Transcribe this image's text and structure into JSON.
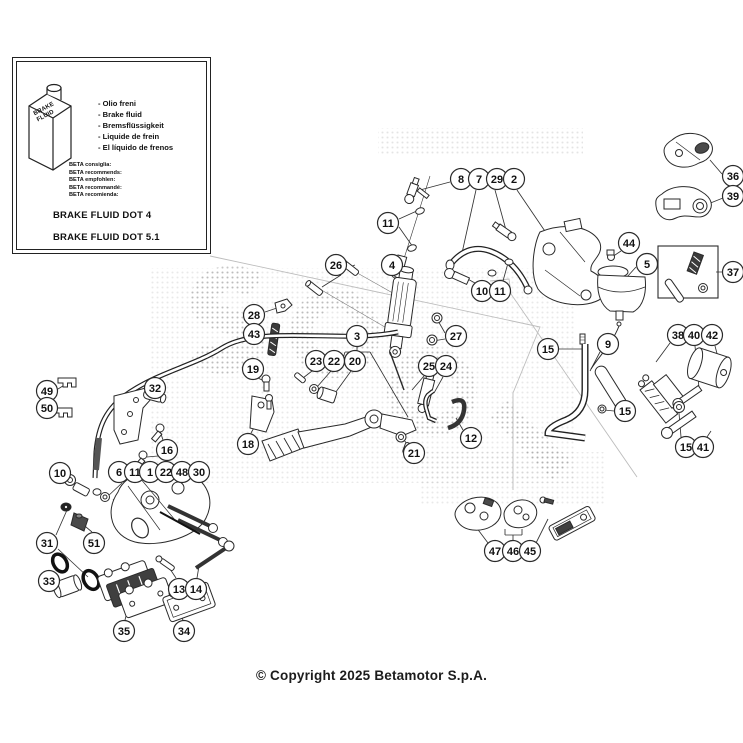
{
  "info_box": {
    "bottle_label": "BRAKE FLUID",
    "fluid_names": [
      "- Olio freni",
      "- Brake fluid",
      "- Bremsflüssigkeit",
      "- Liquide de frein",
      "- El líquido de frenos"
    ],
    "beta_recommends": [
      "BETA consiglia:",
      "BETA recommends:",
      "BETA empfohlen:",
      "BETA recommandé:",
      "BETA recomienda:"
    ],
    "dot4": "BRAKE FLUID DOT 4",
    "dot51": "BRAKE FLUID DOT 5.1"
  },
  "footer": {
    "copyright": "© Copyright 2025 Betamotor S.p.A."
  },
  "colors": {
    "line": "#2a2a2a",
    "faint": "#bdbdbd",
    "dark_fill": "#3f3f3f",
    "halftone": "#8f8f8f"
  },
  "diagram": {
    "callouts": [
      {
        "n": "8",
        "x": 461,
        "y": 179
      },
      {
        "n": "7",
        "x": 479,
        "y": 179
      },
      {
        "n": "29",
        "x": 497,
        "y": 179
      },
      {
        "n": "2",
        "x": 514,
        "y": 179
      },
      {
        "n": "36",
        "x": 733,
        "y": 176
      },
      {
        "n": "39",
        "x": 733,
        "y": 196
      },
      {
        "n": "11",
        "x": 388,
        "y": 223
      },
      {
        "n": "44",
        "x": 629,
        "y": 243
      },
      {
        "n": "26",
        "x": 336,
        "y": 265
      },
      {
        "n": "4",
        "x": 392,
        "y": 265
      },
      {
        "n": "5",
        "x": 647,
        "y": 264
      },
      {
        "n": "37",
        "x": 733,
        "y": 272
      },
      {
        "n": "10",
        "x": 482,
        "y": 291
      },
      {
        "n": "11",
        "x": 500,
        "y": 291
      },
      {
        "n": "28",
        "x": 254,
        "y": 315
      },
      {
        "n": "43",
        "x": 254,
        "y": 334
      },
      {
        "n": "3",
        "x": 357,
        "y": 336
      },
      {
        "n": "27",
        "x": 456,
        "y": 336
      },
      {
        "n": "38",
        "x": 678,
        "y": 335
      },
      {
        "n": "40",
        "x": 694,
        "y": 335
      },
      {
        "n": "42",
        "x": 712,
        "y": 335
      },
      {
        "n": "15",
        "x": 548,
        "y": 349
      },
      {
        "n": "9",
        "x": 608,
        "y": 344
      },
      {
        "n": "23",
        "x": 316,
        "y": 361
      },
      {
        "n": "22",
        "x": 334,
        "y": 361
      },
      {
        "n": "20",
        "x": 355,
        "y": 361
      },
      {
        "n": "25",
        "x": 429,
        "y": 366
      },
      {
        "n": "24",
        "x": 446,
        "y": 366
      },
      {
        "n": "19",
        "x": 253,
        "y": 369
      },
      {
        "n": "49",
        "x": 47,
        "y": 391
      },
      {
        "n": "50",
        "x": 47,
        "y": 408
      },
      {
        "n": "32",
        "x": 155,
        "y": 388
      },
      {
        "n": "15",
        "x": 625,
        "y": 411
      },
      {
        "n": "18",
        "x": 248,
        "y": 444
      },
      {
        "n": "16",
        "x": 167,
        "y": 450
      },
      {
        "n": "12",
        "x": 471,
        "y": 438
      },
      {
        "n": "21",
        "x": 414,
        "y": 453
      },
      {
        "n": "15",
        "x": 686,
        "y": 447
      },
      {
        "n": "41",
        "x": 703,
        "y": 447
      },
      {
        "n": "10",
        "x": 60,
        "y": 473
      },
      {
        "n": "6",
        "x": 119,
        "y": 472
      },
      {
        "n": "11",
        "x": 135,
        "y": 472
      },
      {
        "n": "1",
        "x": 150,
        "y": 472
      },
      {
        "n": "22",
        "x": 166,
        "y": 472
      },
      {
        "n": "48",
        "x": 182,
        "y": 472
      },
      {
        "n": "30",
        "x": 199,
        "y": 472
      },
      {
        "n": "31",
        "x": 47,
        "y": 543
      },
      {
        "n": "51",
        "x": 94,
        "y": 543
      },
      {
        "n": "33",
        "x": 49,
        "y": 581
      },
      {
        "n": "13",
        "x": 179,
        "y": 589
      },
      {
        "n": "14",
        "x": 196,
        "y": 589
      },
      {
        "n": "35",
        "x": 124,
        "y": 631
      },
      {
        "n": "34",
        "x": 184,
        "y": 631
      },
      {
        "n": "47",
        "x": 495,
        "y": 551
      },
      {
        "n": "46",
        "x": 513,
        "y": 551
      },
      {
        "n": "45",
        "x": 530,
        "y": 551
      }
    ]
  }
}
